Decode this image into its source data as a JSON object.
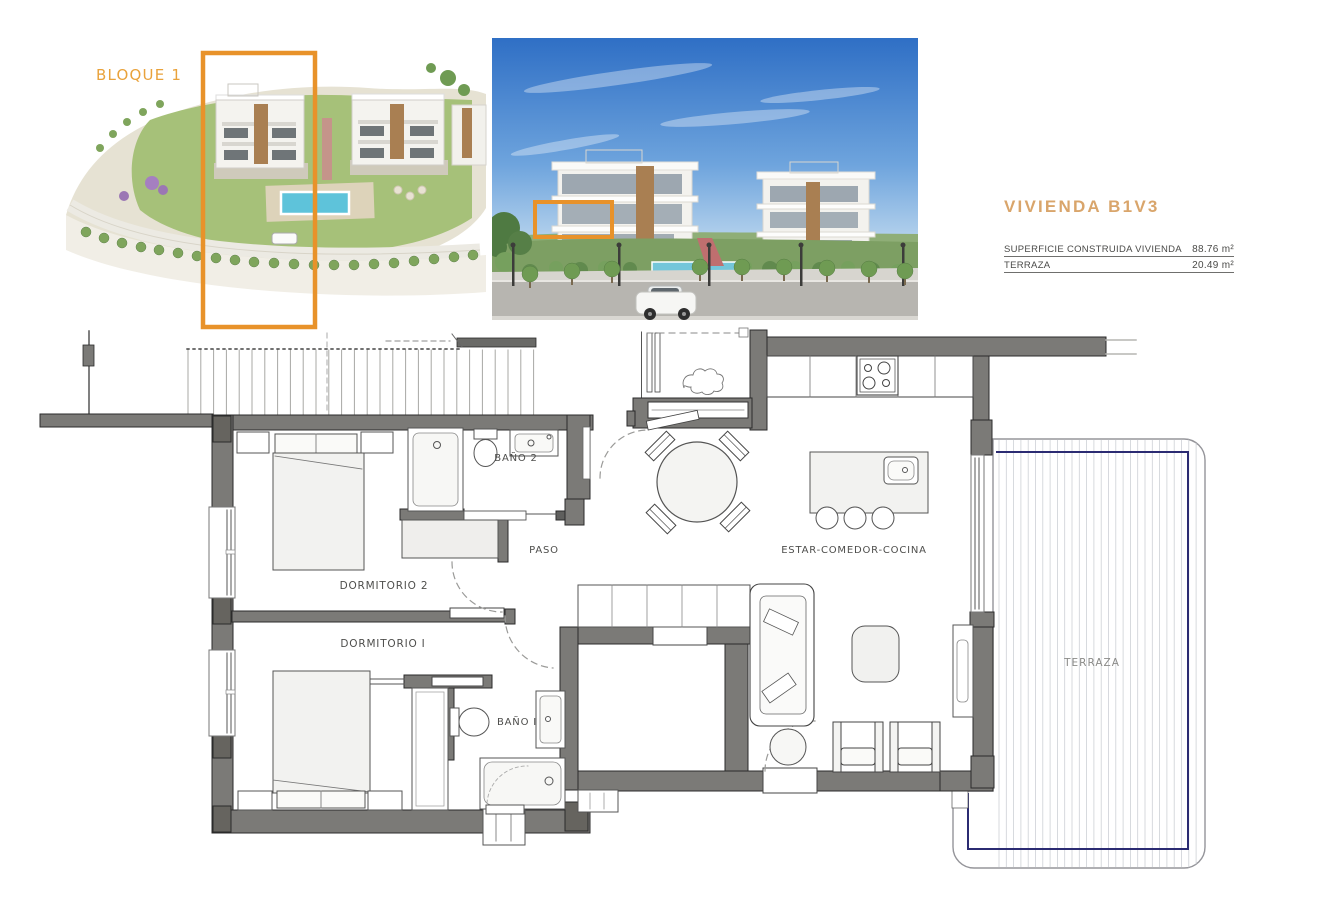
{
  "page": {
    "type": "property-brochure-floor-plan"
  },
  "colors": {
    "accent_orange": "#E8922A",
    "title_tan": "#D9A56B",
    "wall_gray": "#7b7a77",
    "terrace_line_navy": "#2b2b72"
  },
  "site_render": {
    "block_label": "BLOQUE 1"
  },
  "unit_info": {
    "title": "VIVIENDA B1V3",
    "rows": [
      {
        "label": "SUPERFICIE CONSTRUIDA VIVIENDA",
        "value": "88.76 m²"
      },
      {
        "label": "TERRAZA",
        "value": "20.49 m²"
      }
    ]
  },
  "floorplan": {
    "labels": {
      "dormitorio2": "DORMITORIO 2",
      "dormitorio1": "DORMITORIO I",
      "bano2": "BAÑO 2",
      "bano1": "BAÑO I",
      "paso": "PASO",
      "estar_comedor_cocina": "ESTAR-COMEDOR-COCINA",
      "terraza": "TERRAZA"
    }
  }
}
